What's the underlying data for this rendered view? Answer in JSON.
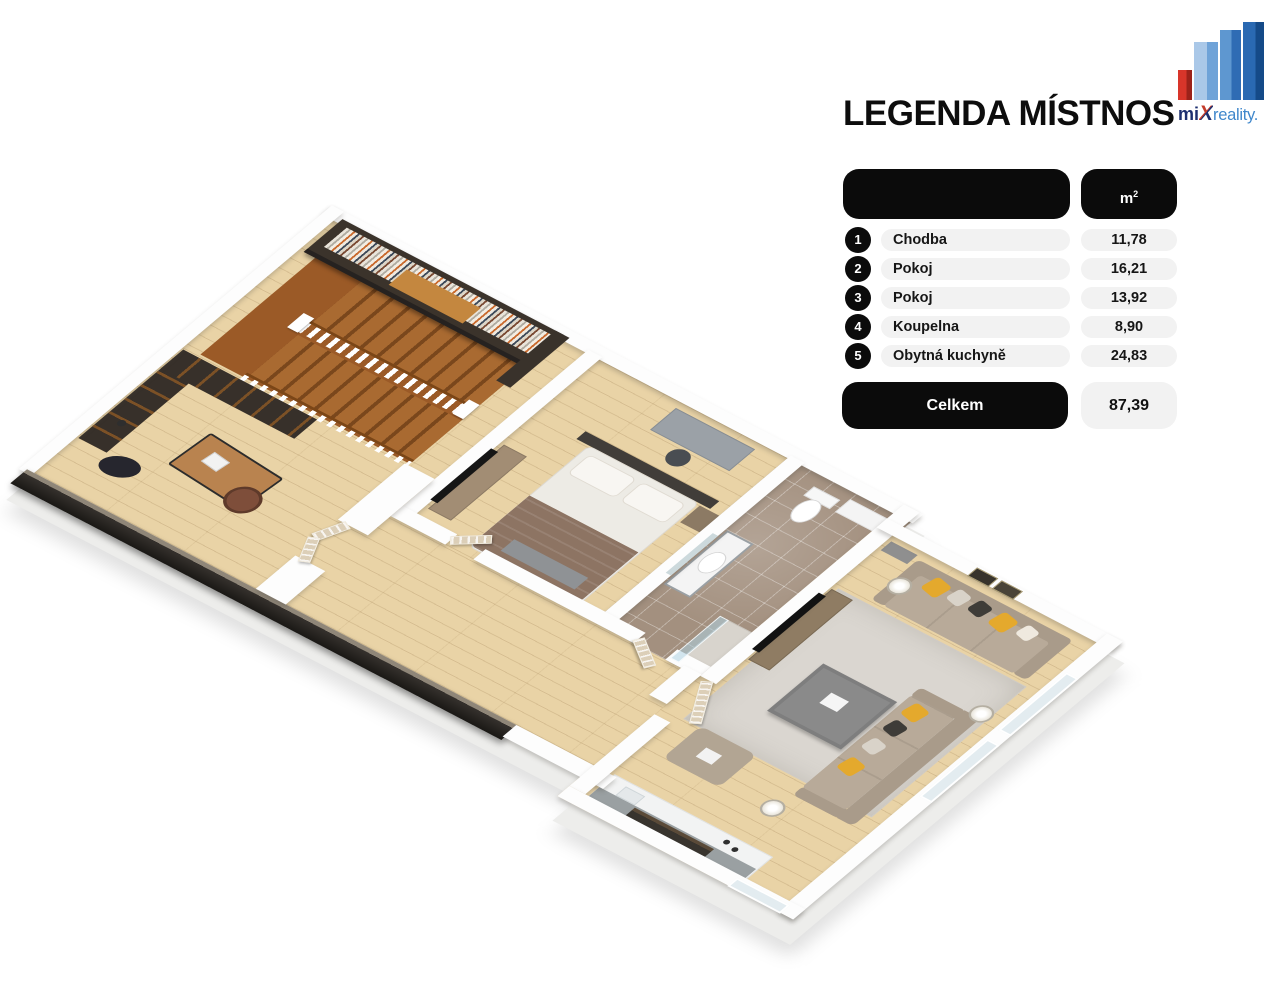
{
  "page": {
    "background": "#ffffff"
  },
  "legend": {
    "title": "LEGENDA MÍSTNOSTÍ",
    "unit_base": "m",
    "unit_exp": "2",
    "rows": [
      {
        "num": "1",
        "label": "Chodba",
        "value": "11,78"
      },
      {
        "num": "2",
        "label": "Pokoj",
        "value": "16,21"
      },
      {
        "num": "3",
        "label": "Pokoj",
        "value": "13,92"
      },
      {
        "num": "4",
        "label": "Koupelna",
        "value": "8,90"
      },
      {
        "num": "5",
        "label": "Obytná kuchyně",
        "value": "24,83"
      }
    ],
    "total_label": "Celkem",
    "total_value": "87,39",
    "colors": {
      "pill_black": "#0b0b0b",
      "pill_gray": "#f2f2f2",
      "text": "#111111"
    }
  },
  "logo": {
    "part_mi": "mi",
    "part_x": "X",
    "part_rest": "reality.",
    "colors": {
      "navy": "#1d2f6f",
      "blue": "#3f87cb",
      "red": "#c43c2b",
      "building_red": "#d8352a",
      "building_blue_light": "#aac8e8",
      "building_blue": "#5e97d0",
      "building_blue_dark": "#2a69b2"
    }
  },
  "floor_plan": {
    "type": "3d-isometric-apartment-render",
    "rooms": [
      "Chodba",
      "Pokoj",
      "Pokoj",
      "Koupelna",
      "Obytná kuchyně"
    ],
    "colors": {
      "wood_floor": "#e9d3a6",
      "stair_wood": "#9b5a27",
      "dark_wall": "#1a1815",
      "marble_floor": "#a3907f",
      "wall_white": "#fdfdfd",
      "sofa": "#b8aa99",
      "pillow_yellow": "#e4a92d",
      "rug": "#dad6d0",
      "door": "#dccfb8"
    }
  }
}
